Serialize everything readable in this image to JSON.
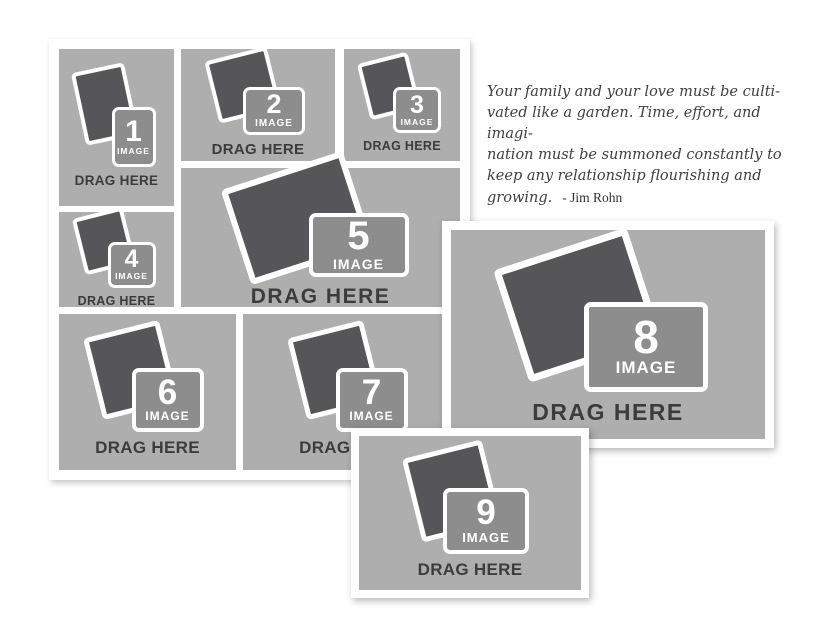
{
  "quote": {
    "lines": [
      "Your family and your love must be culti-",
      "vated like a garden. Time, effort, and imagi-",
      "nation must be summoned constantly to",
      "keep any relationship flourishing and",
      "growing."
    ],
    "attribution": "- Jim Rohn"
  },
  "slots": [
    {
      "number": "1",
      "image_label": "IMAGE",
      "drag_label": "DRAG HERE"
    },
    {
      "number": "2",
      "image_label": "IMAGE",
      "drag_label": "DRAG HERE"
    },
    {
      "number": "3",
      "image_label": "IMAGE",
      "drag_label": "DRAG HERE"
    },
    {
      "number": "4",
      "image_label": "IMAGE",
      "drag_label": "DRAG HERE"
    },
    {
      "number": "5",
      "image_label": "IMAGE",
      "drag_label": "DRAG HERE"
    },
    {
      "number": "6",
      "image_label": "IMAGE",
      "drag_label": "DRAG HERE"
    },
    {
      "number": "7",
      "image_label": "IMAGE",
      "drag_label": "DRAG HERE"
    },
    {
      "number": "8",
      "image_label": "IMAGE",
      "drag_label": "DRAG HERE"
    },
    {
      "number": "9",
      "image_label": "IMAGE",
      "drag_label": "DRAG HERE"
    }
  ],
  "colors": {
    "slot_bg": "#aeaeae",
    "photo_dark": "#565659",
    "label_fill": "#8d8d8d",
    "drag_text": "#3c3c3c",
    "frame_white": "#ffffff",
    "quote_text": "#3f3f3f"
  }
}
